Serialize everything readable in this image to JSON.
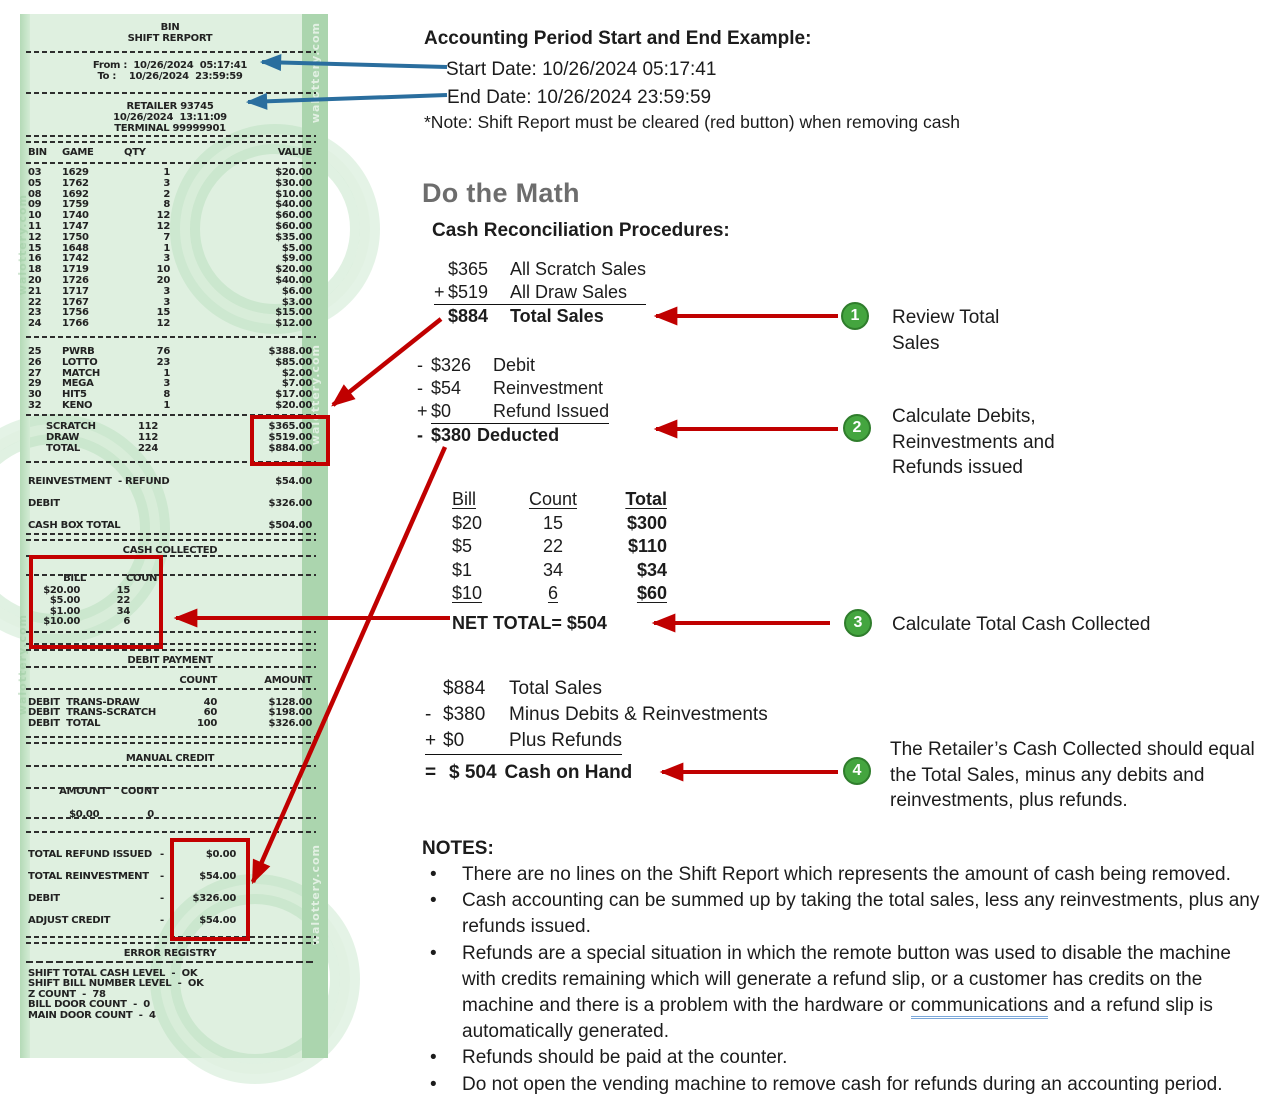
{
  "colors": {
    "accent_red": "#c00000",
    "accent_blue": "#2a6e9e",
    "step_green": "#44a53f",
    "receipt_bg": "#dff0e0",
    "receipt_band": "#abd5ae",
    "highlight_box_red": "#c30000"
  },
  "receipt": {
    "watermark": "walottery.com",
    "header": {
      "line1": "BIN",
      "line2": "SHIFT RERPORT"
    },
    "period": {
      "from_label": "From :",
      "from_value": "10/26/2024  05:17:41",
      "to_label": "To :",
      "to_value": "10/26/2024  23:59:59"
    },
    "retailer": {
      "line1": "RETAILER 93745",
      "line2": "10/26/2024  13:11:09",
      "line3": "TERMINAL 99999901"
    },
    "bin_table": {
      "headers": {
        "bin": "BIN",
        "game": "GAME",
        "qty": "QTY",
        "value": "VALUE"
      },
      "rows": [
        {
          "bin": "03",
          "game": "1629",
          "qty": "1",
          "value": "$20.00"
        },
        {
          "bin": "05",
          "game": "1762",
          "qty": "3",
          "value": "$30.00"
        },
        {
          "bin": "08",
          "game": "1692",
          "qty": "2",
          "value": "$10.00"
        },
        {
          "bin": "09",
          "game": "1759",
          "qty": "8",
          "value": "$40.00"
        },
        {
          "bin": "10",
          "game": "1740",
          "qty": "12",
          "value": "$60.00"
        },
        {
          "bin": "11",
          "game": "1747",
          "qty": "12",
          "value": "$60.00"
        },
        {
          "bin": "12",
          "game": "1750",
          "qty": "7",
          "value": "$35.00"
        },
        {
          "bin": "15",
          "game": "1648",
          "qty": "1",
          "value": "$5.00"
        },
        {
          "bin": "16",
          "game": "1742",
          "qty": "3",
          "value": "$9.00"
        },
        {
          "bin": "18",
          "game": "1719",
          "qty": "10",
          "value": "$20.00"
        },
        {
          "bin": "20",
          "game": "1726",
          "qty": "20",
          "value": "$40.00"
        },
        {
          "bin": "21",
          "game": "1717",
          "qty": "3",
          "value": "$6.00"
        },
        {
          "bin": "22",
          "game": "1767",
          "qty": "3",
          "value": "$3.00"
        },
        {
          "bin": "23",
          "game": "1756",
          "qty": "15",
          "value": "$15.00"
        },
        {
          "bin": "24",
          "game": "1766",
          "qty": "12",
          "value": "$12.00"
        }
      ]
    },
    "game_table": {
      "rows": [
        {
          "bin": "25",
          "game": "PWRB",
          "qty": "76",
          "value": "$388.00"
        },
        {
          "bin": "26",
          "game": "LOTTO",
          "qty": "23",
          "value": "$85.00"
        },
        {
          "bin": "27",
          "game": "MATCH",
          "qty": "1",
          "value": "$2.00"
        },
        {
          "bin": "29",
          "game": "MEGA",
          "qty": "3",
          "value": "$7.00"
        },
        {
          "bin": "30",
          "game": "HIT5",
          "qty": "8",
          "value": "$17.00"
        },
        {
          "bin": "32",
          "game": "KENO",
          "qty": "1",
          "value": "$20.00"
        }
      ]
    },
    "totals": {
      "rows": [
        {
          "label": "SCRATCH",
          "qty": "112",
          "value": "$365.00"
        },
        {
          "label": "DRAW",
          "qty": "112",
          "value": "$519.00"
        },
        {
          "label": "TOTAL",
          "qty": "224",
          "value": "$884.00"
        }
      ]
    },
    "summary": {
      "rows": [
        {
          "label": "REINVESTMENT  - REFUND",
          "value": "$54.00"
        },
        {
          "label": "DEBIT",
          "value": "$326.00"
        },
        {
          "label": "CASH BOX TOTAL",
          "value": "$504.00"
        }
      ]
    },
    "cash_collected": {
      "title": "CASH COLLECTED",
      "bill_header": "BILL",
      "count_header": "COUNT",
      "rows": [
        {
          "bill": "$20.00",
          "count": "15"
        },
        {
          "bill": "$5.00",
          "count": "22"
        },
        {
          "bill": "$1.00",
          "count": "34"
        },
        {
          "bill": "$10.00",
          "count": "6"
        }
      ]
    },
    "debit_payment": {
      "title": "DEBIT PAYMENT",
      "count_header": "COUNT",
      "amount_header": "AMOUNT",
      "rows": [
        {
          "label": "DEBIT  TRANS-DRAW",
          "count": "40",
          "amount": "$128.00"
        },
        {
          "label": "DEBIT  TRANS-SCRATCH",
          "count": "60",
          "amount": "$198.00"
        },
        {
          "label": "DEBIT  TOTAL",
          "count": "100",
          "amount": "$326.00"
        }
      ]
    },
    "manual_credit": {
      "title": "MANUAL CREDIT",
      "amount_header": "AMOUNT",
      "count_header": "COUNT",
      "amount": "$0.00",
      "count": "0"
    },
    "adjustments": {
      "rows": [
        {
          "label": "TOTAL REFUND ISSUED",
          "sep": "-",
          "value": "$0.00"
        },
        {
          "label": "TOTAL REINVESTMENT",
          "sep": "-",
          "value": "$54.00"
        },
        {
          "label": "DEBIT",
          "sep": "-",
          "value": "$326.00"
        },
        {
          "label": "ADJUST CREDIT",
          "sep": "-",
          "value": "$54.00"
        }
      ]
    },
    "error_registry": {
      "title": "ERROR REGISTRY",
      "rows": [
        {
          "text": "SHIFT TOTAL CASH LEVEL  -  OK"
        },
        {
          "text": "SHIFT BILL NUMBER LEVEL  -  OK"
        },
        {
          "text": "Z COUNT  -  78"
        },
        {
          "text": "BILL DOOR COUNT  -  0"
        },
        {
          "text": "MAIN DOOR COUNT  -  4"
        }
      ]
    }
  },
  "accounting_period": {
    "title": "Accounting Period Start and End Example:",
    "start_line": "Start Date:  10/26/2024  05:17:41",
    "end_line": "End Date: 10/26/2024  23:59:59",
    "note": "*Note: Shift Report must be cleared (red button) when removing cash"
  },
  "do_the_math": {
    "heading": "Do the Math",
    "subheading": "Cash Reconciliation Procedures:",
    "math1": {
      "rows": [
        {
          "pre": "",
          "amt": "$365",
          "label": "All Scratch Sales"
        },
        {
          "pre": "+",
          "amt": "$519",
          "label": "All Draw Sales"
        },
        {
          "pre": "",
          "amt": "$884",
          "label": "Total Sales"
        }
      ]
    },
    "math2": {
      "rows": [
        {
          "pre": "-",
          "amt": "$326",
          "label": "Debit"
        },
        {
          "pre": "-",
          "amt": "$54",
          "label": "Reinvestment"
        },
        {
          "pre": "+",
          "amt": "$0",
          "label": "Refund Issued"
        },
        {
          "pre": "-",
          "amt": "$380",
          "label": "Deducted"
        }
      ]
    },
    "bill_table": {
      "headers": {
        "bill": "Bill",
        "count": "Count",
        "total": "Total"
      },
      "rows": [
        {
          "bill": "$20",
          "count": "15",
          "total": "$300"
        },
        {
          "bill": "$5",
          "count": "22",
          "total": "$110"
        },
        {
          "bill": "$1",
          "count": "34",
          "total": "$34"
        },
        {
          "bill": "$10",
          "count": "6",
          "total": "$60"
        }
      ],
      "net_total": "NET TOTAL= $504"
    },
    "math4": {
      "rows": [
        {
          "pre": "",
          "amt": "$884",
          "label": "Total Sales"
        },
        {
          "pre": "-",
          "amt": "$380",
          "label": "Minus Debits & Reinvestments"
        },
        {
          "pre": "+",
          "amt": "$0",
          "label": "Plus Refunds"
        },
        {
          "pre": "=",
          "amt": "$ 504",
          "label": "Cash on Hand"
        }
      ]
    }
  },
  "steps": [
    {
      "num": "1",
      "text": "Review Total Sales"
    },
    {
      "num": "2",
      "text": "Calculate Debits, Reinvestments and Refunds issued"
    },
    {
      "num": "3",
      "text": "Calculate Total Cash Collected"
    },
    {
      "num": "4",
      "text": "The Retailer’s Cash Collected should equal the Total Sales, minus any debits and reinvestments, plus refunds."
    }
  ],
  "notes": {
    "title": "NOTES:",
    "bullets": [
      {
        "marker": "•",
        "before": "There are no lines on the Shift Report which represents the amount of cash being removed.",
        "link": "",
        "after": ""
      },
      {
        "marker": "•",
        "before": "Cash accounting can be summed up by taking the total sales, less any reinvestments, plus any refunds issued.",
        "link": "",
        "after": ""
      },
      {
        "marker": "•",
        "before": "Refunds are a special situation in which the remote button was used to disable the machine with credits remaining which will generate a refund slip, or a customer has credits on the machine and there is a problem with the hardware or ",
        "link": "communications",
        "after": " and a refund slip is automatically generated."
      },
      {
        "marker": "•",
        "before": "Refunds should be paid at the counter.",
        "link": "",
        "after": ""
      },
      {
        "marker": "•",
        "before": "Do not open the vending machine to remove cash for refunds during an accounting period.",
        "link": "",
        "after": ""
      }
    ]
  }
}
